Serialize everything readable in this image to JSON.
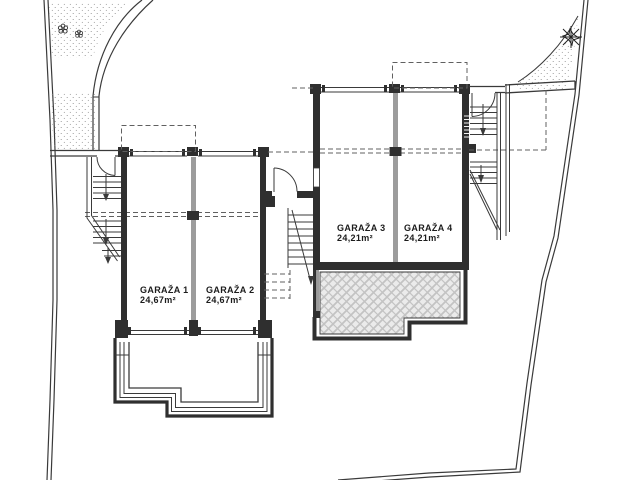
{
  "plan": {
    "title": "garage-level-site-plan",
    "garages": [
      {
        "label": "GARAŽA 1",
        "area": "24,67m²"
      },
      {
        "label": "GARAŽA 2",
        "area": "24,67m²"
      },
      {
        "label": "GARAŽA 3",
        "area": "24,21m²"
      },
      {
        "label": "GARAŽA 4",
        "area": "24,21m²"
      }
    ],
    "symbols": {
      "tree": "tree-icon",
      "flowers": "flower-icon",
      "stairs": "stair-run-with-down-arrow",
      "terrace": "hatched-paving"
    },
    "colors": {
      "wall": "#2f2f2f",
      "line": "#3a3a3a",
      "divider": "#9c9c9c",
      "dashed": "#606060",
      "text": "#1c1c1c",
      "hatchbg": "#ebebeb",
      "hatchln": "#c3c3c3",
      "bg": "#ffffff",
      "dot": "#8a8a8a"
    }
  }
}
